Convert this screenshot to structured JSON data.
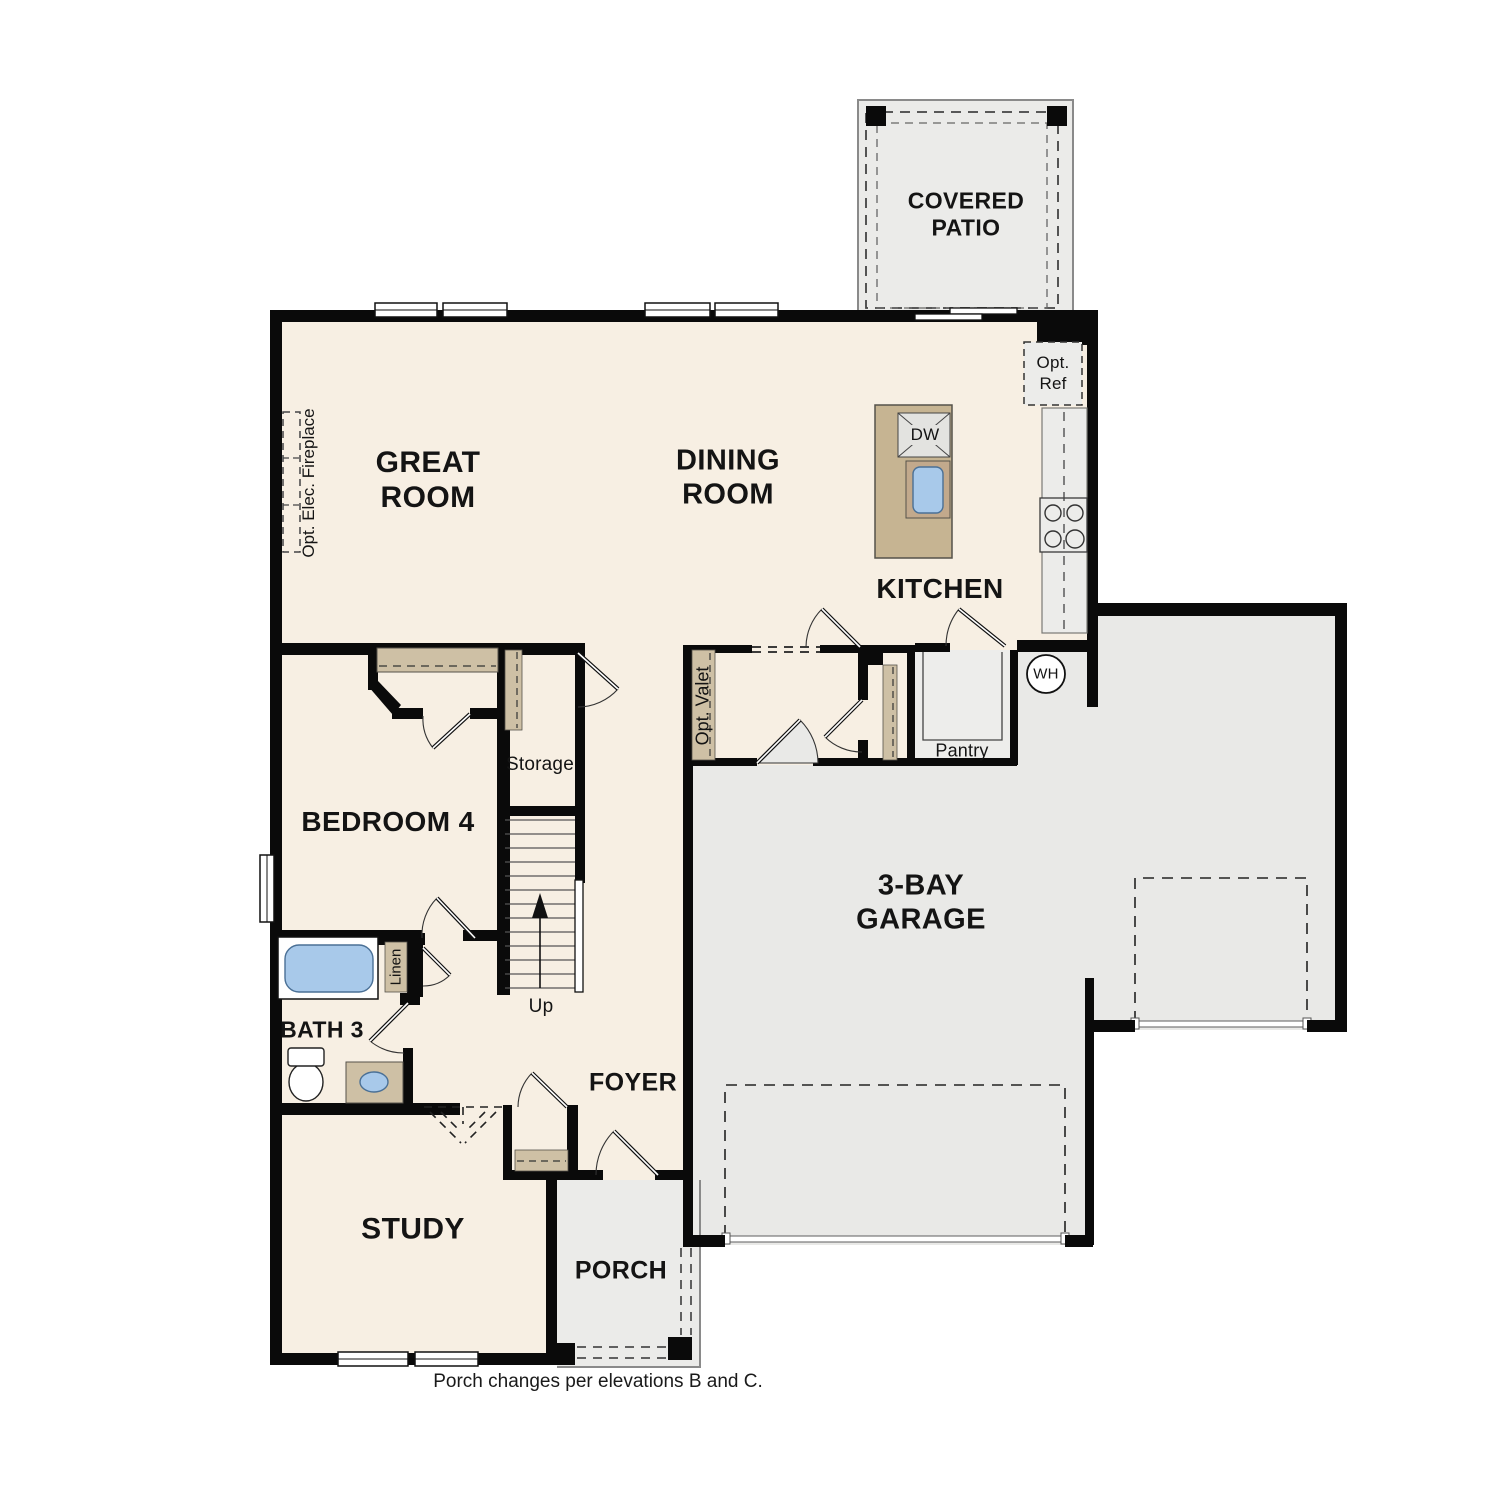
{
  "labels": {
    "covered_patio": "COVERED\nPATIO",
    "great_room": "GREAT\nROOM",
    "dining_room": "DINING\nROOM",
    "kitchen": "KITCHEN",
    "bedroom4": "BEDROOM 4",
    "storage": "Storage",
    "up": "Up",
    "bath3": "BATH 3",
    "linen": "Linen",
    "foyer": "FOYER",
    "study": "STUDY",
    "porch": "PORCH",
    "garage": "3-BAY\nGARAGE",
    "pantry": "Pantry",
    "dw": "DW",
    "wh": "WH",
    "opt_ref": "Opt.\nRef",
    "opt_valet": "Opt. Valet",
    "opt_fireplace": "Opt. Elec. Fireplace",
    "caption": "Porch changes per elevations B and C."
  },
  "colors": {
    "floor": "#f7efe3",
    "garage_floor": "#e9e9e7",
    "patio_floor": "#ebebe9",
    "casework_tan": "#cec0a5",
    "island_tan": "#c6b492",
    "fixture_blue": "#a8c9ea",
    "wall_black": "#0a0a0a"
  }
}
